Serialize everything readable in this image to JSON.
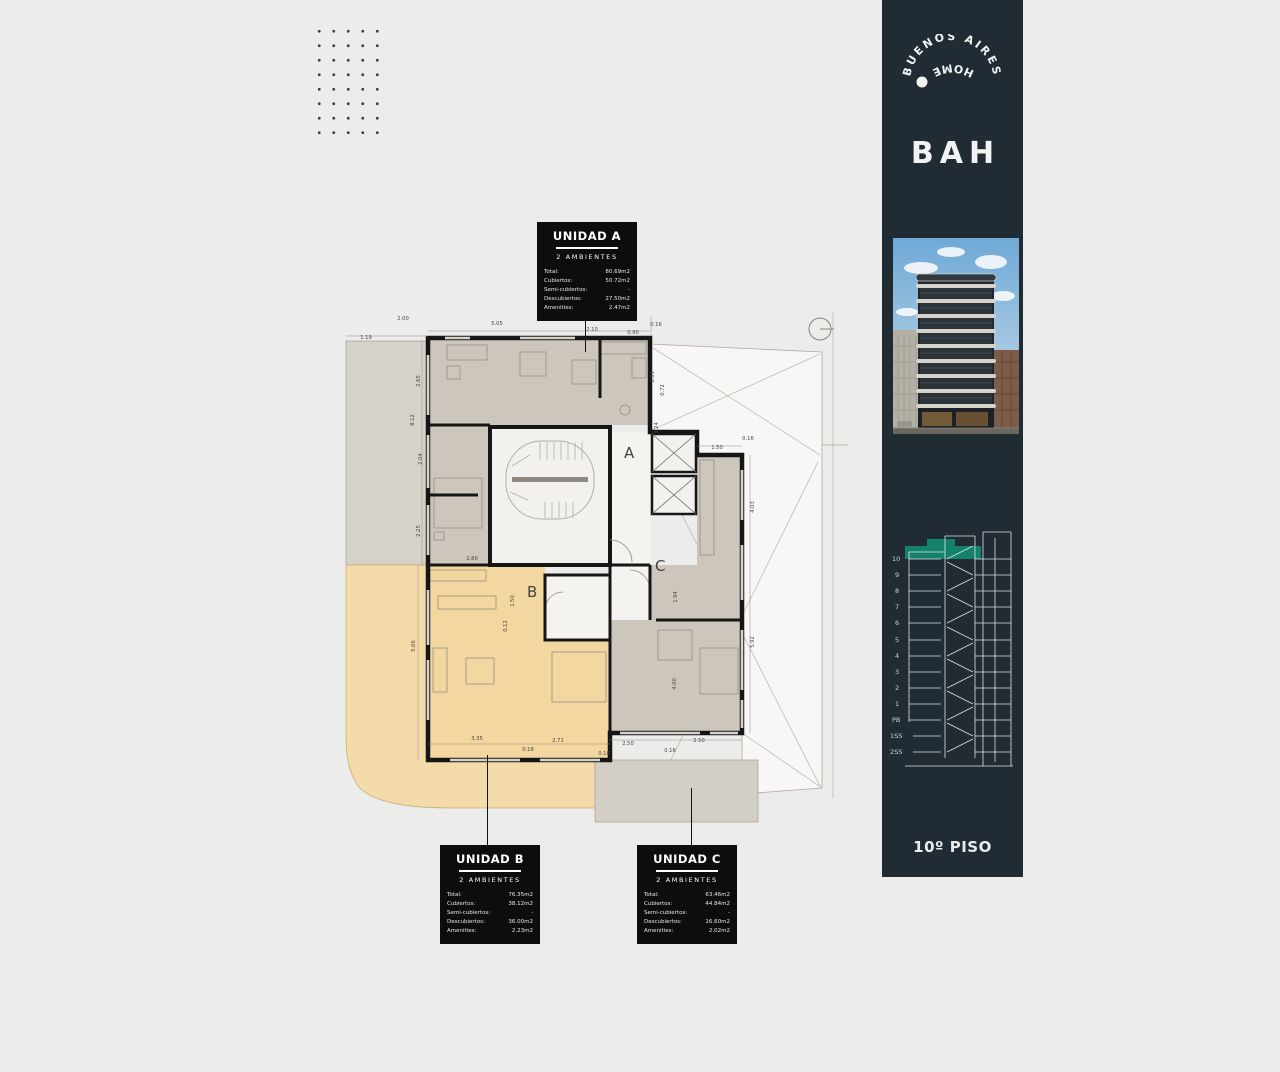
{
  "page": {
    "bg": "#ecedeb"
  },
  "sidebar": {
    "bg": "#212b33",
    "accent_teal": "#14816c",
    "logo": {
      "arc_text": "BUENOS AIRES",
      "arc_text_2": "HOME",
      "wordmark": "BAH"
    },
    "floors": [
      "10",
      "9",
      "8",
      "7",
      "6",
      "5",
      "4",
      "3",
      "2",
      "1",
      "PB",
      "1SS",
      "2SS"
    ],
    "floor_caption": "10º PISO"
  },
  "units": [
    {
      "title": "UNIDAD A",
      "subtitle": "2 AMBIENTES",
      "rows": [
        {
          "label": "Total:",
          "value": "80.69m2"
        },
        {
          "label": "Cubiertos:",
          "value": "50.72m2"
        },
        {
          "label": "Semi-cubiertos:",
          "value": "-"
        },
        {
          "label": "Descubiertos:",
          "value": "27.50m2"
        },
        {
          "label": "Amenities:",
          "value": "2.47m2"
        }
      ]
    },
    {
      "title": "UNIDAD B",
      "subtitle": "2 AMBIENTES",
      "rows": [
        {
          "label": "Total:",
          "value": "76.35m2"
        },
        {
          "label": "Cubiertos:",
          "value": "38.12m2"
        },
        {
          "label": "Semi-cubiertos:",
          "value": "-"
        },
        {
          "label": "Descubiertos:",
          "value": "36.00m2"
        },
        {
          "label": "Amenities:",
          "value": "2.23m2"
        }
      ]
    },
    {
      "title": "UNIDAD C",
      "subtitle": "2 AMBIENTES",
      "rows": [
        {
          "label": "Total:",
          "value": "63.46m2"
        },
        {
          "label": "Cubiertos:",
          "value": "44.84m2"
        },
        {
          "label": "Semi-cubiertos:",
          "value": "-"
        },
        {
          "label": "Descubiertos:",
          "value": "16.60m2"
        },
        {
          "label": "Amenities:",
          "value": "2.02m2"
        }
      ]
    }
  ],
  "plan": {
    "letters": {
      "a": "A",
      "b": "B",
      "c": "C"
    },
    "colors": {
      "unit_a": "#cdc6bd",
      "unit_b": "#f3d7a0",
      "unit_c": "#cdc6bd",
      "terrace_grey": "#d7d2c9",
      "terrace_tan": "#f4dbaa",
      "terrace_grey2": "#d4cfc6",
      "wall": "#161616"
    },
    "dims": {
      "top": [
        "1.19",
        "2.00",
        "5.05",
        "2.10",
        "0.90",
        "0.16"
      ],
      "left": [
        "2.65",
        "8.12",
        "2.04",
        "2.25",
        "5.66"
      ],
      "bottom": [
        "3.35",
        "0.16",
        "2.71",
        "0.18",
        "2.50",
        "0.16",
        "2.50"
      ],
      "right": [
        "1.50",
        "0.16",
        "4.03",
        "5.92"
      ],
      "inner": [
        "2.80",
        "1.91",
        "0.72",
        "3.24",
        "1.94",
        "4.00",
        "1.50",
        "0.12"
      ]
    }
  }
}
